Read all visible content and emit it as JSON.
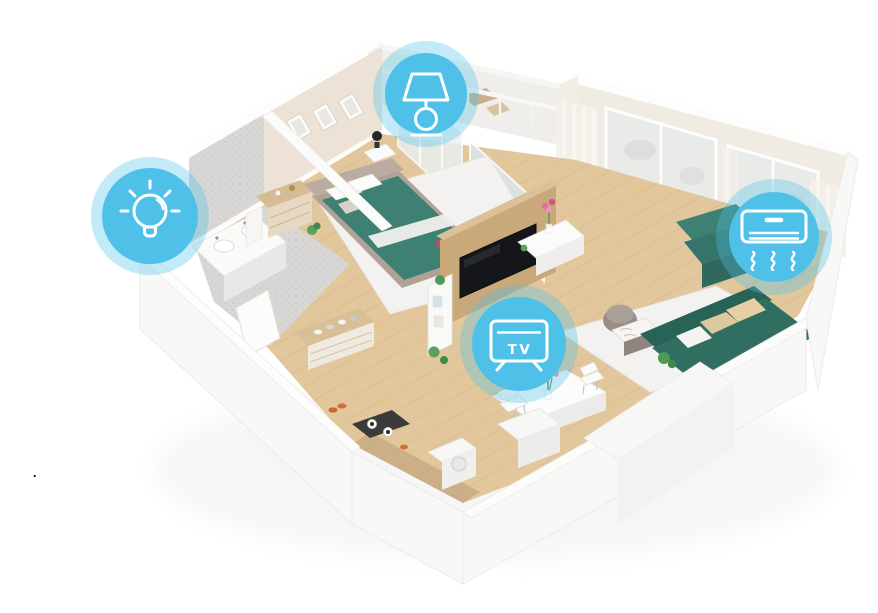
{
  "page": {
    "background": "#ffffff",
    "stray_dot": "."
  },
  "hotspots": [
    {
      "id": "bathroom-lighting",
      "icon": "light-bulb-icon"
    },
    {
      "id": "bedroom-lamp",
      "icon": "table-lamp-icon"
    },
    {
      "id": "living-room-tv",
      "icon": "tv-icon",
      "label": "TV"
    },
    {
      "id": "air-conditioner",
      "icon": "air-conditioner-icon"
    }
  ],
  "colors": {
    "badge": "#4FC1E9",
    "icon_stroke": "#FFFFFF",
    "teal": "#3E8173",
    "teal_dark": "#2F6E61",
    "wood": "#E3C79C",
    "wood_panel": "#C9A87A",
    "wall_beige": "#ECE2D5",
    "stone": "#D8D7D5",
    "white_wall": "#F8F8F7",
    "rug": "#F3F2F0",
    "glass": "#DCE4E5"
  }
}
